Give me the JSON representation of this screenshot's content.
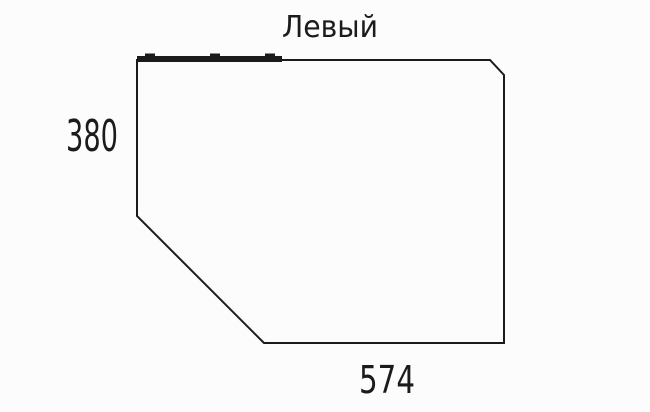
{
  "drawing": {
    "title": "Левый",
    "height_label": "380",
    "width_label": "574",
    "colors": {
      "line": "#1b1b1b",
      "background": "#fcfcfc"
    }
  }
}
